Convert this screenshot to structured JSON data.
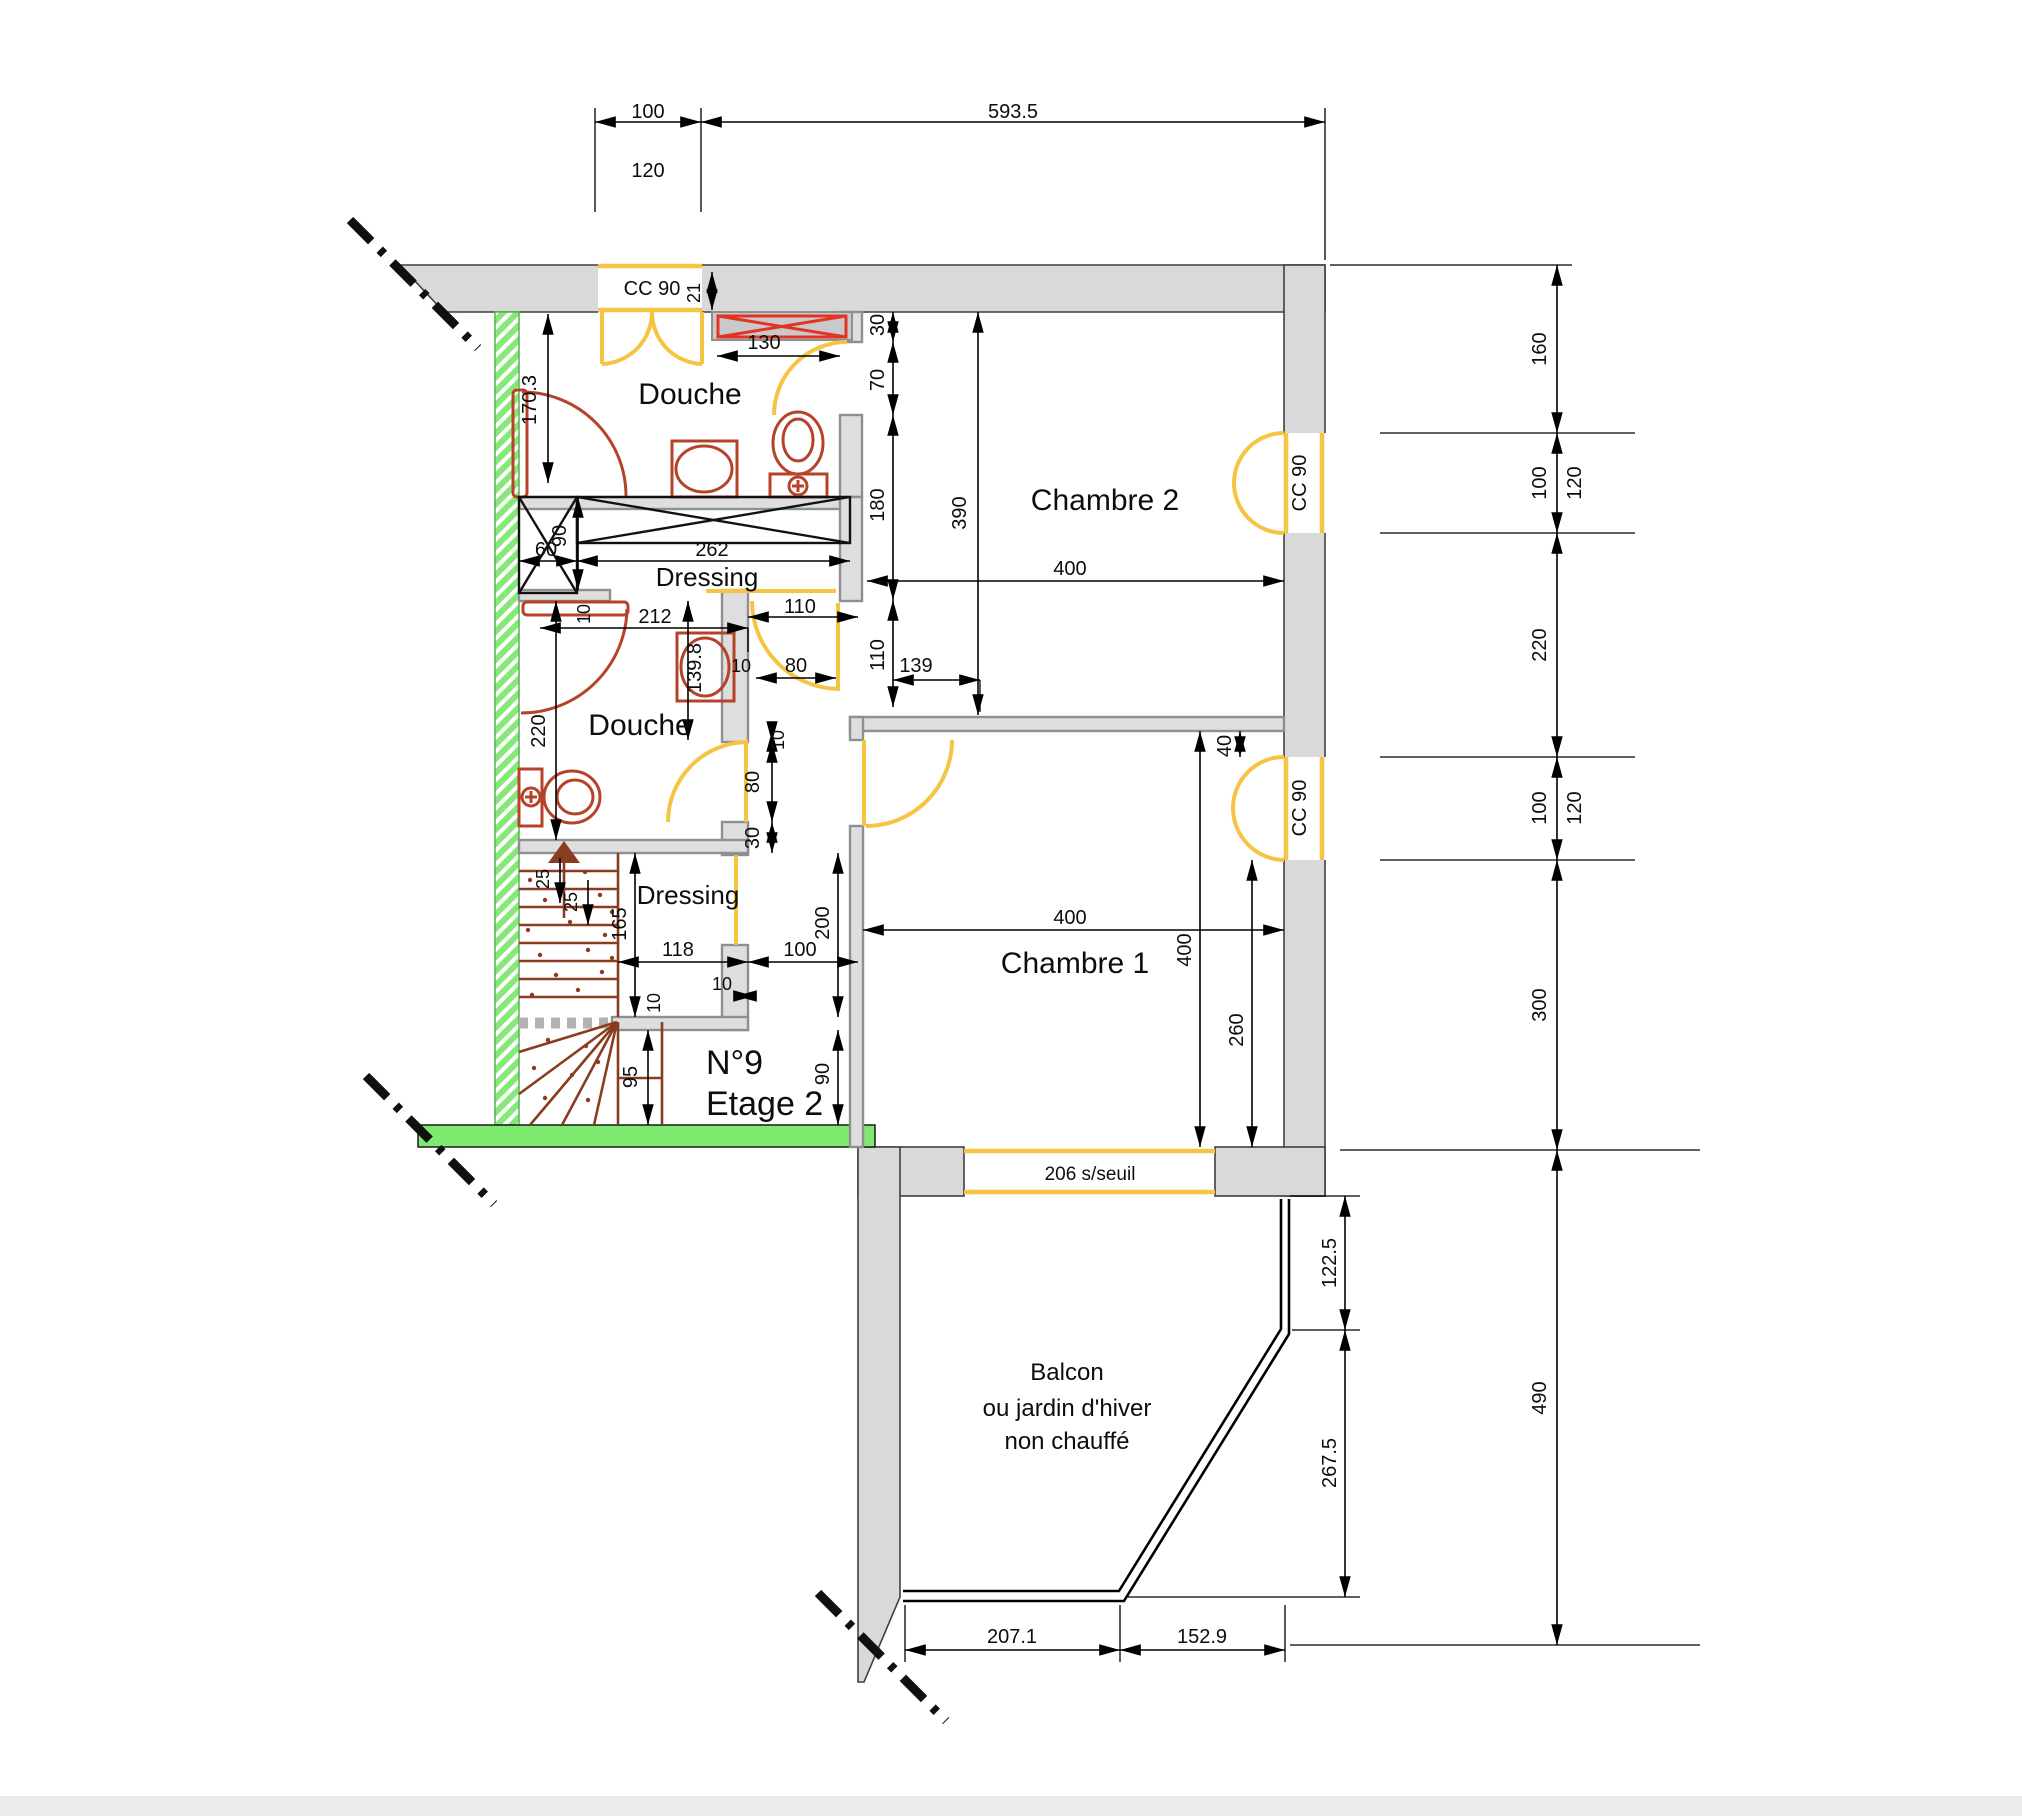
{
  "title": {
    "unit": "N°9",
    "floor": "Etage 2"
  },
  "rooms": {
    "douche1": "Douche",
    "douche2": "Douche",
    "dressing1": "Dressing",
    "dressing2": "Dressing",
    "chambre1": "Chambre 1",
    "chambre2": "Chambre 2",
    "balcon_line1": "Balcon",
    "balcon_line2": "ou jardin d'hiver",
    "balcon_line3": "non chauffé"
  },
  "doors": {
    "cc90_top": "CC 90",
    "cc90_chambre2": "CC 90",
    "cc90_chambre1": "CC 90",
    "window_seuil": "206 s/seuil"
  },
  "dims": {
    "top_100": "100",
    "top_593": "593.5",
    "top_120": "120",
    "right_160": "160",
    "right_100a": "100",
    "right_120a": "120",
    "right_220": "220",
    "right_100b": "100",
    "right_120b": "120",
    "right_300": "300",
    "right_490": "490",
    "w21": "21",
    "w130": "130",
    "w30a": "30",
    "w70": "70",
    "w180": "180",
    "w110v": "110",
    "w139": "139",
    "w390": "390",
    "w400_ch2": "400",
    "w170": "170.3",
    "w90a": "90",
    "w60": "60",
    "w262": "262",
    "w212": "212",
    "w10a": "10",
    "w139_8": "139.8",
    "w110h": "110",
    "w80h": "80",
    "w10b": "10",
    "w220": "220",
    "w10c": "10",
    "w80v": "80",
    "w30b": "30",
    "w40": "40",
    "w400_ch1h": "400",
    "w400_ch1v": "400",
    "w260": "260",
    "w200": "200",
    "w90b": "90",
    "w25a": "25",
    "w25b": "25",
    "w165": "165",
    "w118": "118",
    "w100h": "100",
    "w10d": "10",
    "w10e": "10",
    "w95": "95",
    "b122": "122.5",
    "b267": "267.5",
    "b207": "207.1",
    "b152": "152.9"
  },
  "colors": {
    "wall_grey": "#d9d9d9",
    "party_wall_green": "#87e87a",
    "floor_band_green": "#7dea6f",
    "door_yellow": "#f5c443",
    "fixture_red": "#b5432a",
    "radiator_red": "#e23425",
    "stair_brown": "#8a3c1e"
  }
}
